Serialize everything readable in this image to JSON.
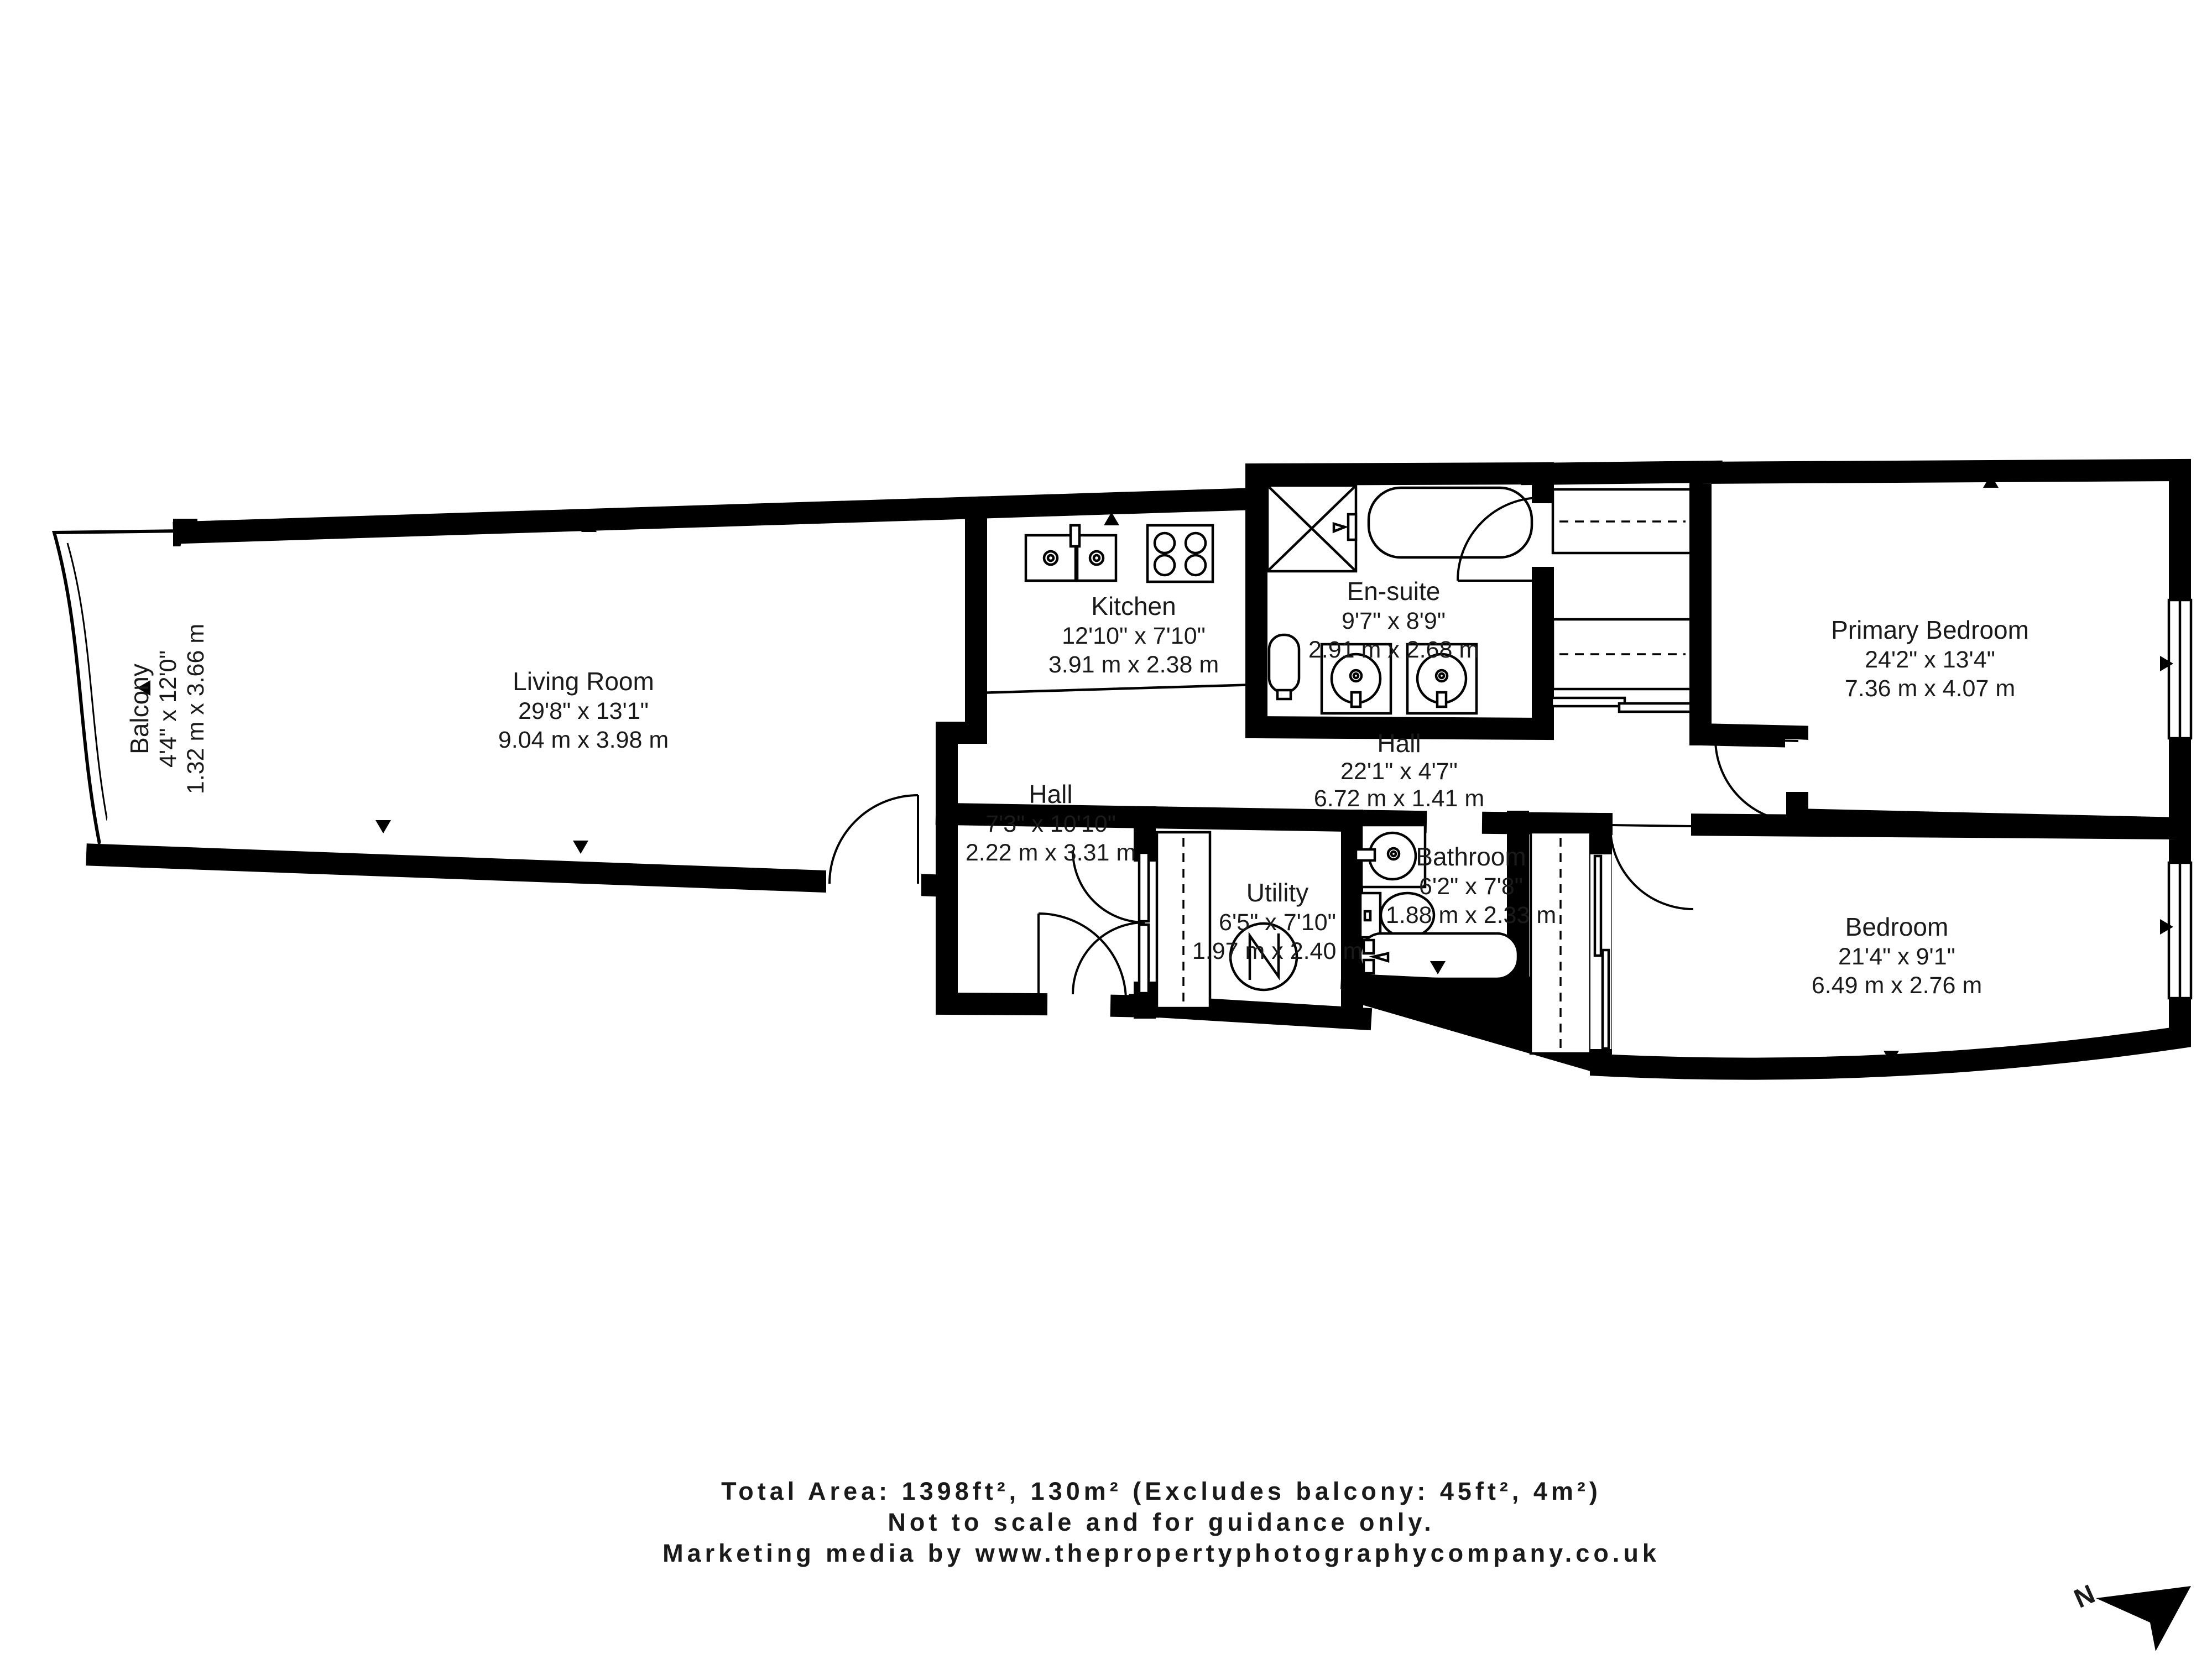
{
  "title": "Apartment floor plan",
  "rooms": [
    {
      "name": "Balcony",
      "imperial": "4'4\" x 12'0\"",
      "metric": "1.32 m x 3.66 m"
    },
    {
      "name": "Living Room",
      "imperial": "29'8\" x 13'1\"",
      "metric": "9.04 m x 3.98 m"
    },
    {
      "name": "Kitchen",
      "imperial": "12'10\" x 7'10\"",
      "metric": "3.91 m x 2.38 m"
    },
    {
      "name": "En-suite",
      "imperial": "9'7\" x 8'9\"",
      "metric": "2.91 m x 2.68 m"
    },
    {
      "name": "Primary Bedroom",
      "imperial": "24'2\" x 13'4\"",
      "metric": "7.36 m x 4.07 m"
    },
    {
      "name": "Hall",
      "imperial": "22'1\" x 4'7\"",
      "metric": "6.72 m x 1.41 m"
    },
    {
      "name": "Hall",
      "imperial": "7'3\" x 10'10\"",
      "metric": "2.22 m x 3.31 m"
    },
    {
      "name": "Utility",
      "imperial": "6'5\" x 7'10\"",
      "metric": "1.97 m x 2.40 m"
    },
    {
      "name": "Bathroom",
      "imperial": "6'2\" x 7'8\"",
      "metric": "1.88 m x 2.33 m"
    },
    {
      "name": "Bedroom",
      "imperial": "21'4\" x 9'1\"",
      "metric": "6.49 m x 2.76 m"
    }
  ],
  "footer": {
    "line1": "Total Area: 1398ft², 130m² (Excludes balcony: 45ft², 4m²)",
    "line2": "Not to scale and for guidance only.",
    "line3": "Marketing media by www.thepropertyphotographycompany.co.uk"
  },
  "compass": {
    "label": "N"
  },
  "colors": {
    "wall": "#000000",
    "floor": "#ffffff",
    "text": "#1a1a1a"
  }
}
